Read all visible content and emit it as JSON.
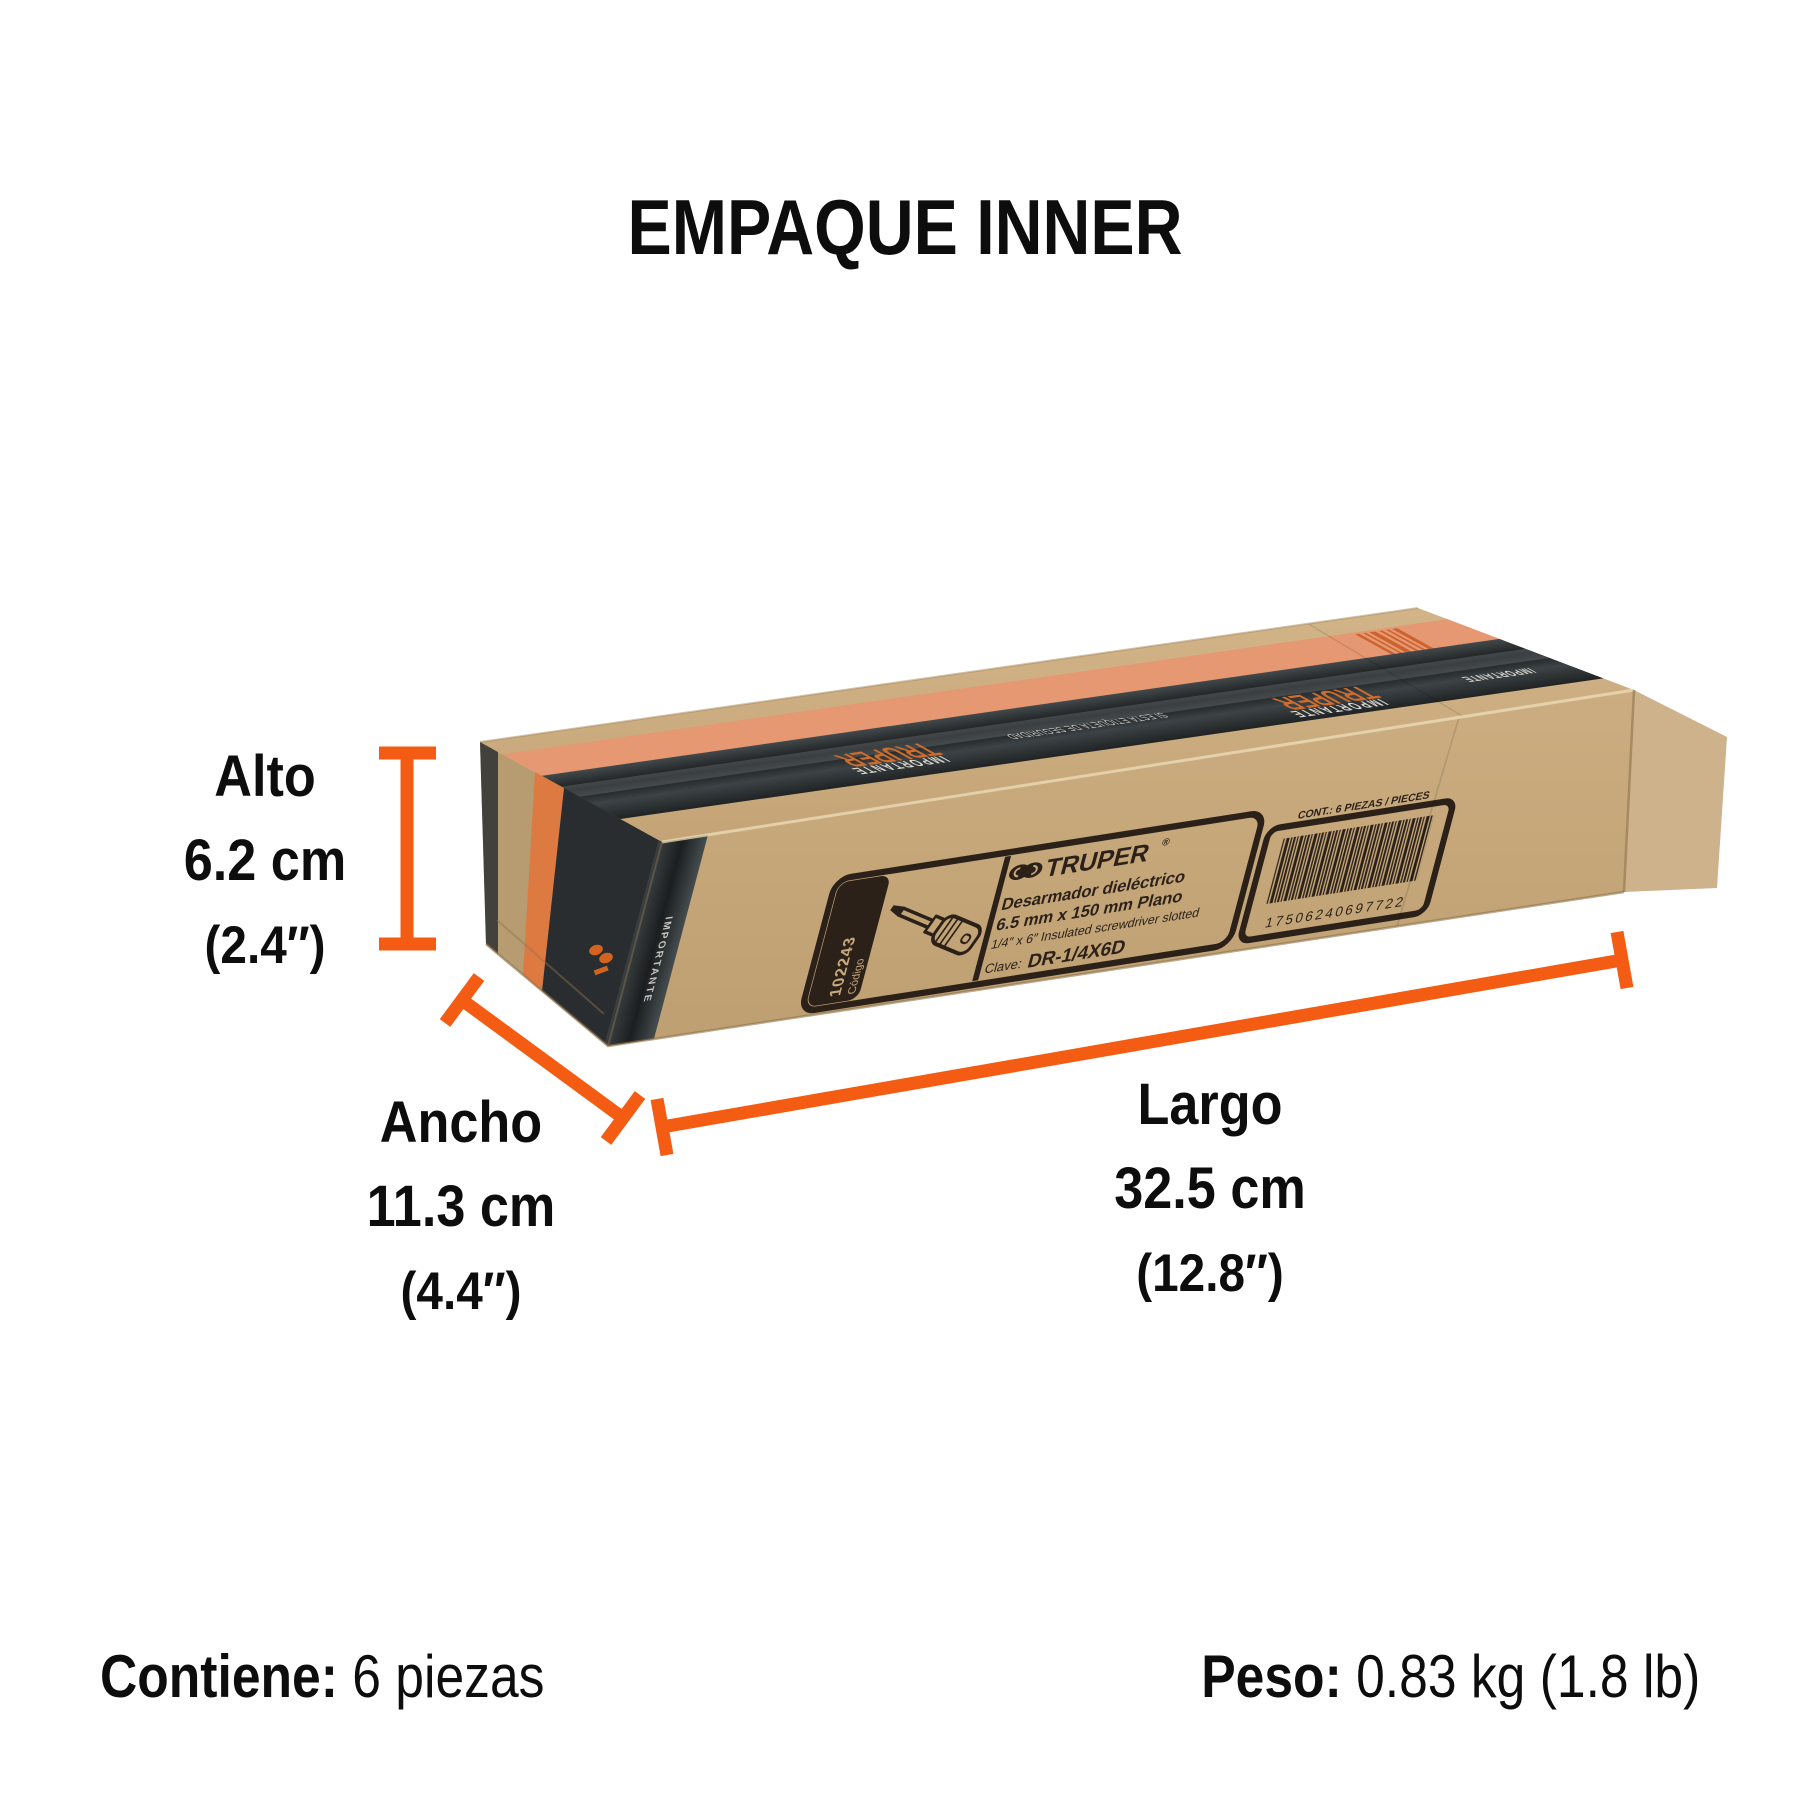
{
  "title": "EMPAQUE INNER",
  "dimensions": {
    "alto": {
      "name": "Alto",
      "cm": "6.2 cm",
      "inch": "(2.4″)"
    },
    "ancho": {
      "name": "Ancho",
      "cm": "11.3 cm",
      "inch": "(4.4″)"
    },
    "largo": {
      "name": "Largo",
      "cm": "32.5 cm",
      "inch": "(12.8″)"
    }
  },
  "footer": {
    "contains_label": "Contiene:",
    "contains_value": "6 piezas",
    "weight_label": "Peso:",
    "weight_value": "0.83 kg (1.8 lb)"
  },
  "box_label": {
    "brand": "TRUPER",
    "reg_mark": "®",
    "desc_line1": "Desarmador dieléctrico",
    "desc_line2": "6.5 mm x 150 mm Plano",
    "desc_line3": "1/4″ x 6″ Insulated screwdriver slotted",
    "clave_label": "Clave:",
    "clave_value": "DR-1/4X6D",
    "codigo_label": "Código",
    "codigo_value": "102243",
    "barcode_caption": "CONT.: 6 PIEZAS / PIECES",
    "barcode_number": "17506240697722"
  },
  "tape": {
    "brand": "TRUPER",
    "word": "IMPORTANTE",
    "security_note": "SI ESTA ETIQUETA DE SEGURIDAD"
  },
  "colors": {
    "accent_orange": "#f35c12",
    "cardboard": "#c7a87c",
    "tape_dark": "#2b2e30",
    "stripe_salmon": "#e59872",
    "label_ink": "#2b2119"
  }
}
